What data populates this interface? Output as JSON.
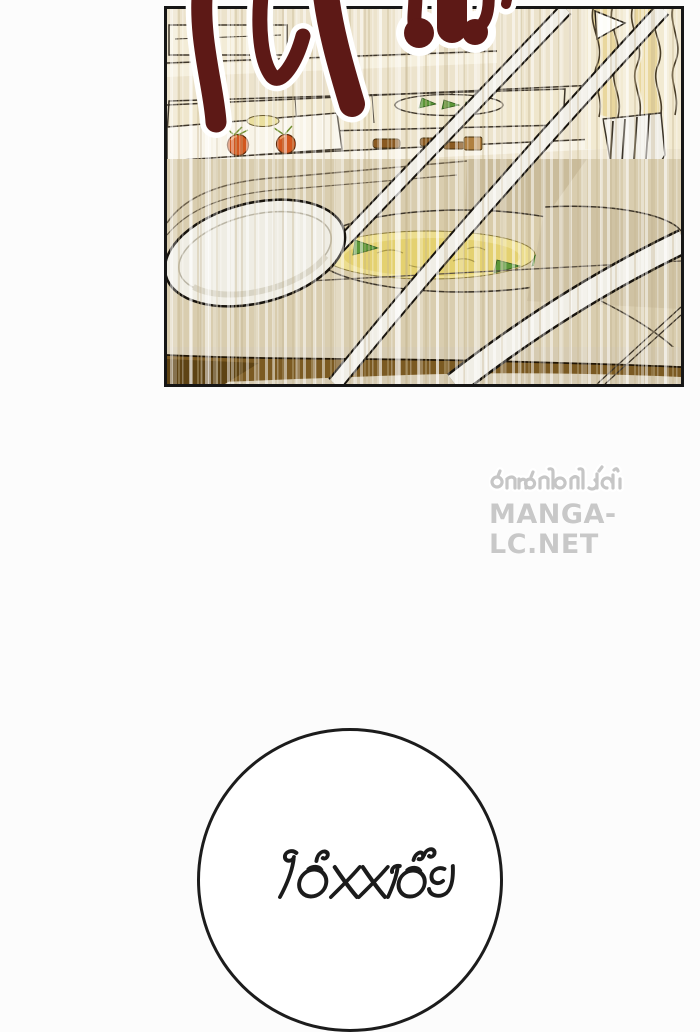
{
  "page": {
    "background": "#fcfcfc"
  },
  "sfx": {
    "color": "#5d1916",
    "outline": "#ffffff"
  },
  "panel": {
    "border_color": "#161616",
    "colors": {
      "background": "#e9e0cb",
      "tray_cream": "#f3ecd8",
      "tray_tan": "#d9cdaf",
      "soup": "#e4d170",
      "soup_rim": "#ecdd8e",
      "greens": "#5c9638",
      "tomato": "#d2571f",
      "table_brown": "#7b5a22",
      "utensil": "#f0eee6",
      "noodle": "#e9d79e"
    }
  },
  "watermark": {
    "line1": "อ่านก่อนใครได้ที่",
    "line2": "MANGA-LC.NET",
    "color": "#c6c6c6"
  },
  "speech_bubble": {
    "text": "ไอ้XXเอ๊ย",
    "fill": "#ffffff",
    "border_color": "#1c1c1c",
    "text_color": "#1b1b1b"
  }
}
